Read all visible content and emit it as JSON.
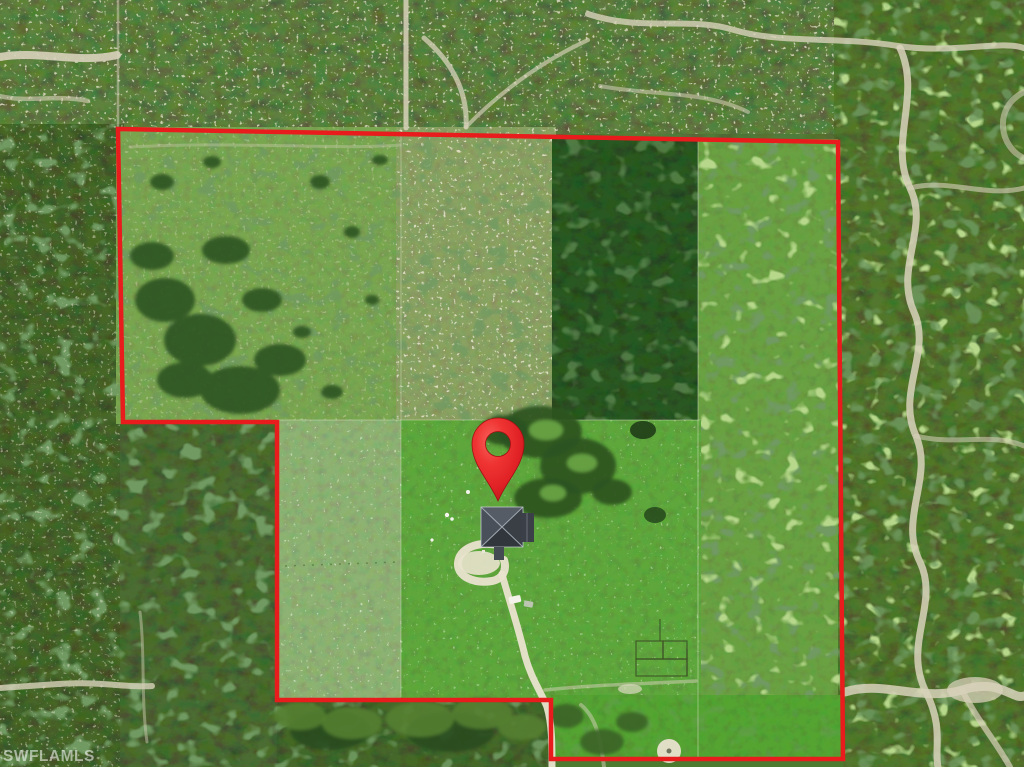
{
  "watermark": {
    "text": "SWFLAMLS"
  },
  "overlay": {
    "boundary": {
      "points": "118,129 838,142 843,759 551,759 551,700 277,700 277,422 123,422",
      "color": "#e81c1c",
      "stroke_width": "4.5"
    },
    "pin": {
      "transform": "translate(498,501)",
      "color": "#ee2a2c"
    }
  },
  "palette": {
    "boundary_red": "#e81c1c",
    "pin_red": "#ee2a2c",
    "bright_field_green": "#5fa73c",
    "pale_field_green": "#8eb273",
    "dense_woods_green": "#2c5922",
    "outside_forest_green": "#4a6a2f",
    "trail_sand": "#d8d2bb",
    "driveway_sand": "#e9e3cd",
    "roof_gray": "#454a52",
    "watermark_white": "#ffffff"
  }
}
